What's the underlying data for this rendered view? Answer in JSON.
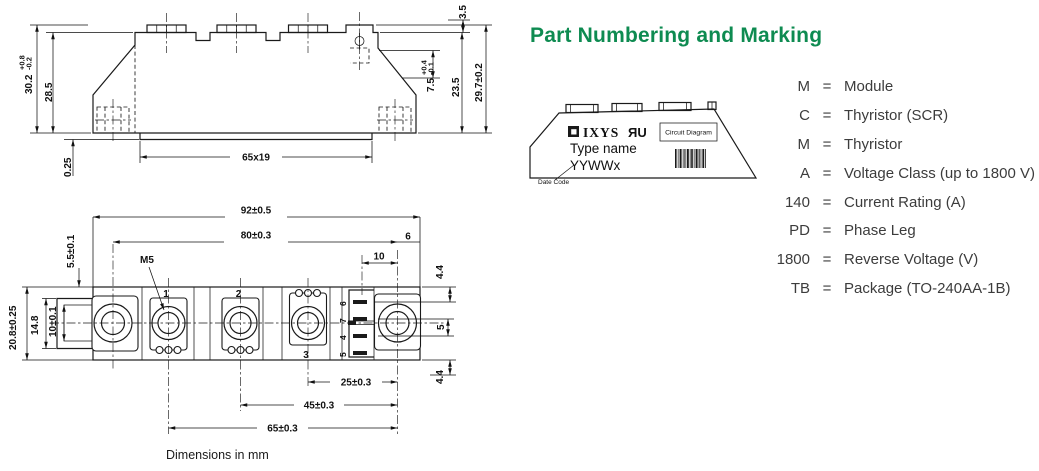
{
  "title": "Part Numbering and Marking",
  "colors": {
    "accent_green": "#0e8b51",
    "line": "#1a1a1a",
    "text": "#3c3c3c"
  },
  "side_view": {
    "labels": {
      "h_total": "30.2",
      "h_total_tol_plus": "+0.8",
      "h_total_tol_minus": "-0.2",
      "h_body": "28.5",
      "base_offset": "0.25",
      "base_size": "65x19",
      "pin_height": "3.5",
      "gate_h": "7.5",
      "gate_h_tol_plus": "+0.4",
      "gate_h_tol_minus": "-0.1",
      "h_inner": "23.5",
      "h_overall": "29.7±0.2"
    }
  },
  "top_view": {
    "labels": {
      "w_total": "92±0.5",
      "hole_pitch": "80±0.3",
      "pin_offset": "10",
      "edge_offset": "6",
      "thread": "M5",
      "slot_offset": "5.5±0.1",
      "depth_total": "20.8±0.25",
      "ear_height": "14.8",
      "slot_width": "10±0.1",
      "pin_top_gap": "4.4",
      "pin_pitch": "5",
      "pin_bot_gap": "4.4",
      "pitch_25": "25±0.3",
      "pitch_45": "45±0.3",
      "pitch_65": "65±0.3",
      "terminal_1": "1",
      "terminal_2": "2",
      "terminal_3": "3",
      "pin_6": "6",
      "pin_7": "7",
      "pin_4": "4",
      "pin_5": "5"
    },
    "note": "Dimensions in mm"
  },
  "package": {
    "brand": "IXYS",
    "ul_mark": "ЯU",
    "circuit_diagram_label": "Circuit Diagram",
    "type_name": "Type name",
    "date_code_value": "YYWWx",
    "date_code_label": "Date Code"
  },
  "legend": [
    {
      "key": "M",
      "eq": "=",
      "value": "Module"
    },
    {
      "key": "C",
      "eq": "=",
      "value": "Thyristor (SCR)"
    },
    {
      "key": "M",
      "eq": "=",
      "value": "Thyristor"
    },
    {
      "key": "A",
      "eq": "=",
      "value": "Voltage Class (up to 1800 V)"
    },
    {
      "key": "140",
      "eq": "=",
      "value": "Current Rating (A)"
    },
    {
      "key": "PD",
      "eq": "=",
      "value": "Phase Leg"
    },
    {
      "key": "1800",
      "eq": "=",
      "value": "Reverse Voltage (V)"
    },
    {
      "key": "TB",
      "eq": "=",
      "value": "Package (TO-240AA-1B)"
    }
  ]
}
